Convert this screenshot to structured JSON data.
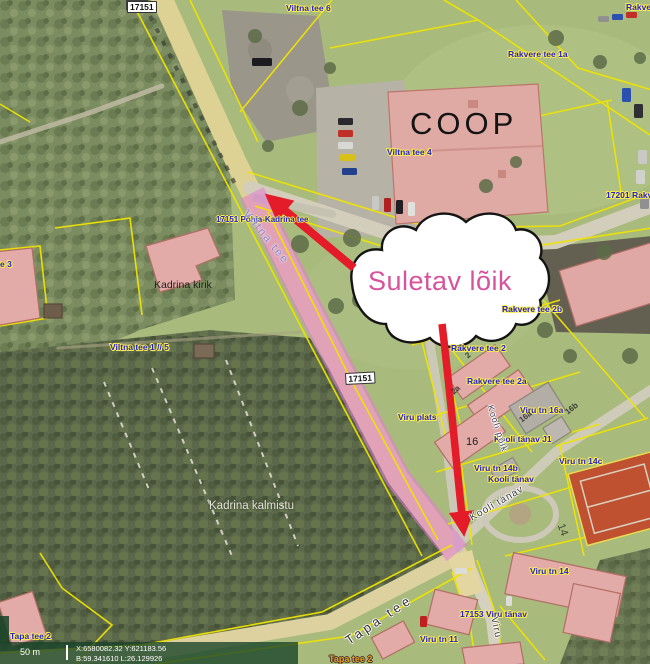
{
  "window": {
    "width": 650,
    "height": 664
  },
  "map": {
    "callout": {
      "text": "Suletav lõik",
      "text_color": "#d8539d",
      "fill": "#ffffff",
      "outline": "#141414"
    },
    "closure_highlight_color": "#e07bd5",
    "arrow_color": "#e41b28",
    "cadastral_line_color": "#f0e400",
    "address_label_color": "#2222cc",
    "labels": [
      {
        "id": "road-number-top",
        "text": "17151",
        "cls": "roadnum",
        "x": 127,
        "y": 1
      },
      {
        "id": "viltna-tee-6",
        "text": "Viltna tee 6",
        "cls": "addr",
        "x": 286,
        "y": 4
      },
      {
        "id": "rakvere-top-right",
        "text": "Rakver",
        "cls": "addr",
        "x": 626,
        "y": 3
      },
      {
        "id": "rakvere-tee-1a",
        "text": "Rakvere tee 1a",
        "cls": "addr",
        "x": 508,
        "y": 50
      },
      {
        "id": "coop",
        "text": "COOP",
        "cls": "coop",
        "x": 410,
        "y": 107
      },
      {
        "id": "viltna-tee-4",
        "text": "Viltna tee 4",
        "cls": "addr",
        "x": 387,
        "y": 148
      },
      {
        "id": "rakvere-17201",
        "text": "17201 Rakv",
        "cls": "addr",
        "x": 606,
        "y": 191
      },
      {
        "id": "road-17151-name",
        "text": "17151 Põhja-Kadrina tee",
        "cls": "addr-sm",
        "x": 216,
        "y": 216
      },
      {
        "id": "tee-3-clipped",
        "text": "e 3",
        "cls": "addr",
        "x": 0,
        "y": 260
      },
      {
        "id": "kadrina-kirik",
        "text": "Kadrina kirik",
        "cls": "black",
        "x": 154,
        "y": 280
      },
      {
        "id": "viltna-tee-1-5",
        "text": "Viltna tee 1 // 5",
        "cls": "addr",
        "x": 110,
        "y": 343
      },
      {
        "id": "rakvere-tee-2b",
        "text": "Rakvere tee 2b",
        "cls": "addr",
        "x": 502,
        "y": 305
      },
      {
        "id": "rakvere-tee-2",
        "text": "Rakvere tee 2",
        "cls": "addr",
        "x": 451,
        "y": 344
      },
      {
        "id": "rakvere-tee-2a",
        "text": "Rakvere tee 2a",
        "cls": "addr",
        "x": 467,
        "y": 377
      },
      {
        "id": "viru-tn-16a",
        "text": "Viru tn 16a",
        "cls": "addr",
        "x": 520,
        "y": 406
      },
      {
        "id": "viru-plats",
        "text": "Viru plats",
        "cls": "addr",
        "x": 398,
        "y": 413
      },
      {
        "id": "num-16",
        "text": "16",
        "cls": "num",
        "x": 466,
        "y": 436
      },
      {
        "id": "kooli-tanav-j1",
        "text": "Kooli tänav J1",
        "cls": "addr",
        "x": 494,
        "y": 435
      },
      {
        "id": "viru-tn-14b",
        "text": "Viru tn 14b",
        "cls": "addr",
        "x": 474,
        "y": 464
      },
      {
        "id": "kooli-tanav-addr",
        "text": "Kooli tänav",
        "cls": "addr",
        "x": 488,
        "y": 475
      },
      {
        "id": "viru-tn-14c",
        "text": "Viru tn 14c",
        "cls": "addr",
        "x": 559,
        "y": 457
      },
      {
        "id": "kadrina-kalmistu",
        "text": "Kadrina kalmistu",
        "cls": "white",
        "x": 209,
        "y": 500
      },
      {
        "id": "viru-tn-14",
        "text": "Viru tn 14",
        "cls": "addr",
        "x": 530,
        "y": 567
      },
      {
        "id": "viru-17153",
        "text": "17153 Viru tänav",
        "cls": "addr",
        "x": 460,
        "y": 610
      },
      {
        "id": "viru-tn-11",
        "text": "Viru tn 11",
        "cls": "addr",
        "x": 420,
        "y": 635
      },
      {
        "id": "tapa-tee-2",
        "text": "Tapa tee 2",
        "cls": "addr",
        "x": 10,
        "y": 632
      },
      {
        "id": "tapa-tee-2-clipped",
        "text": "Tapa tee 2",
        "cls": "addr-orange",
        "x": 329,
        "y": 655
      },
      {
        "id": "road-number-mid",
        "text": "17151",
        "cls": "roadnum",
        "x": 345,
        "y": 373,
        "rot": -3
      },
      {
        "id": "street-viltna-tee",
        "text": "Viltna tee",
        "cls": "street-onroad",
        "x": 250,
        "y": 208,
        "rot": 51
      },
      {
        "id": "street-kooli-poik",
        "text": "Kooli põik",
        "cls": "street-sm",
        "x": 494,
        "y": 404,
        "rot": 72
      },
      {
        "id": "street-kooli-tanav",
        "text": "Kooli tänav",
        "cls": "street-md",
        "x": 468,
        "y": 514,
        "rot": -30
      },
      {
        "id": "street-tapa-tee",
        "text": "Tapa tee",
        "cls": "street-lg",
        "x": 343,
        "y": 636,
        "rot": -34
      },
      {
        "id": "street-viru",
        "text": "Viru",
        "cls": "street-md",
        "x": 499,
        "y": 616,
        "rot": 78
      },
      {
        "id": "parcel-2",
        "text": "2",
        "cls": "parcel",
        "x": 464,
        "y": 354,
        "rot": -40
      },
      {
        "id": "parcel-2a",
        "text": "2a",
        "cls": "parcel",
        "x": 450,
        "y": 390,
        "rot": -40
      },
      {
        "id": "parcel-16a",
        "text": "16a",
        "cls": "parcel",
        "x": 518,
        "y": 418,
        "rot": -38
      },
      {
        "id": "parcel-16b",
        "text": "16b",
        "cls": "parcel",
        "x": 564,
        "y": 410,
        "rot": -38
      },
      {
        "id": "parcel-14",
        "text": "14",
        "cls": "parcel-lg",
        "x": 566,
        "y": 522,
        "rot": 70
      }
    ]
  },
  "status_bar": {
    "scale": "50 m",
    "coord_line1": "X:6580082.32 Y:621183.56",
    "coord_line2": "B:59.341610 L:26.129926"
  }
}
